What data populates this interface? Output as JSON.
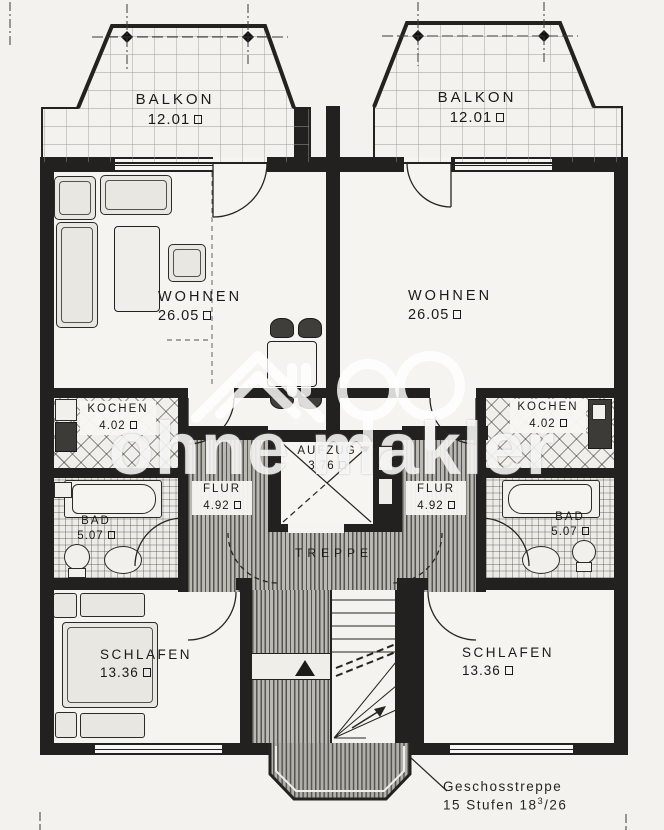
{
  "watermark": {
    "text": "ohne makler"
  },
  "rooms": {
    "balkon_left": {
      "label": "BALKON",
      "area": "12.01"
    },
    "balkon_right": {
      "label": "BALKON",
      "area": "12.01"
    },
    "wohnen_left": {
      "label": "WOHNEN",
      "area": "26.05"
    },
    "wohnen_right": {
      "label": "WOHNEN",
      "area": "26.05"
    },
    "kochen_left": {
      "label": "KOCHEN",
      "area": "4.02"
    },
    "kochen_right": {
      "label": "KOCHEN",
      "area": "4.02"
    },
    "bad_left": {
      "label": "BAD",
      "area": "5.07"
    },
    "bad_right": {
      "label": "BAD",
      "area": "5.07"
    },
    "flur_left": {
      "label": "FLUR",
      "area": "4.92"
    },
    "flur_right": {
      "label": "FLUR",
      "area": "4.92"
    },
    "aufzug": {
      "label": "AUFZUG",
      "area": "3.76"
    },
    "treppe": {
      "label": "TREPPE"
    },
    "schlafen_left": {
      "label": "SCHLAFEN",
      "area": "13.36"
    },
    "schlafen_right": {
      "label": "SCHLAFEN",
      "area": "13.36"
    }
  },
  "annotation": {
    "line1": "Geschosstreppe",
    "line2_pre": "15 Stufen 18",
    "line2_sup": "3",
    "line2_post": "/26"
  },
  "colors": {
    "ink": "#22211f",
    "paper": "#f3f2ee",
    "hatch_gray": "#bab8b2",
    "furniture_dark": "#403e3a",
    "watermark_white": "#ffffff"
  }
}
